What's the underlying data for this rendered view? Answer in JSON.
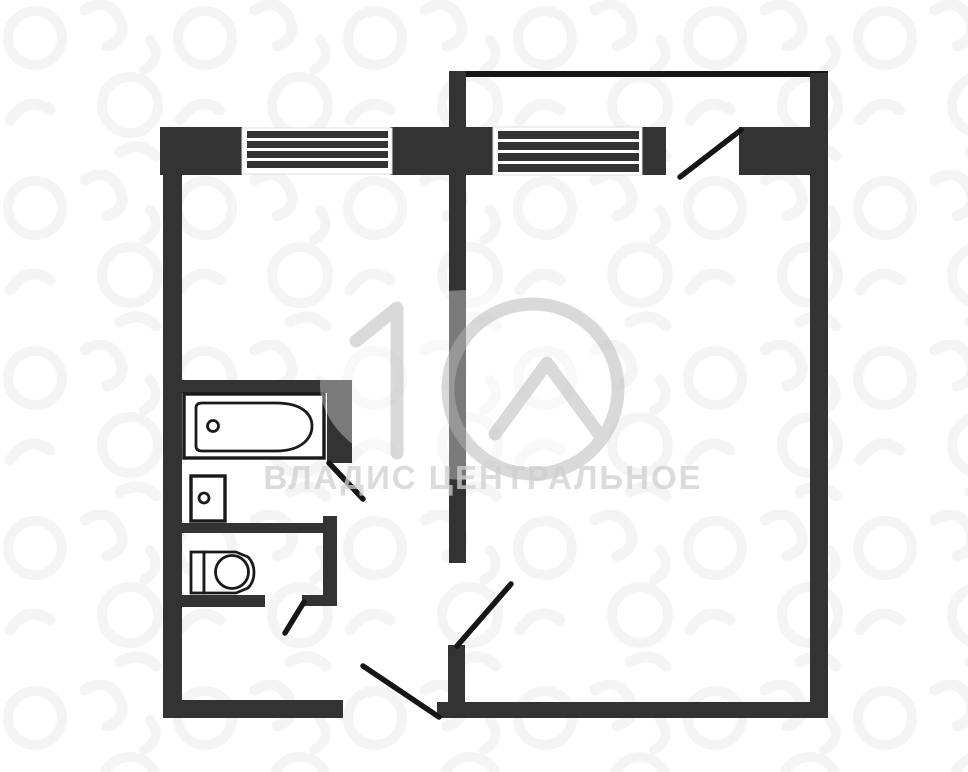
{
  "watermark": {
    "text": "ВЛАДИС ЦЕНТРАЛЬНОЕ",
    "logo": "house-number-10-logo"
  },
  "colors": {
    "bg": "#ffffff",
    "wall": "#333333",
    "line": "#161616",
    "fixture": "#1a1a1a",
    "pattern": "#f4f4f4",
    "window_frame": "#dcdcdc",
    "watermark_logo": "#b5b5b5",
    "watermark_text": "#cfcfcf"
  },
  "plan": {
    "type": "apartment-floor-plan",
    "symbols": {
      "windows": [
        "window-icon",
        "window-icon"
      ],
      "doors": [
        "door-swing-icon",
        "door-swing-icon",
        "door-swing-icon",
        "door-swing-icon",
        "door-swing-icon"
      ],
      "fixtures": [
        "bathtub-icon",
        "washbasin-icon",
        "toilet-icon"
      ]
    }
  }
}
